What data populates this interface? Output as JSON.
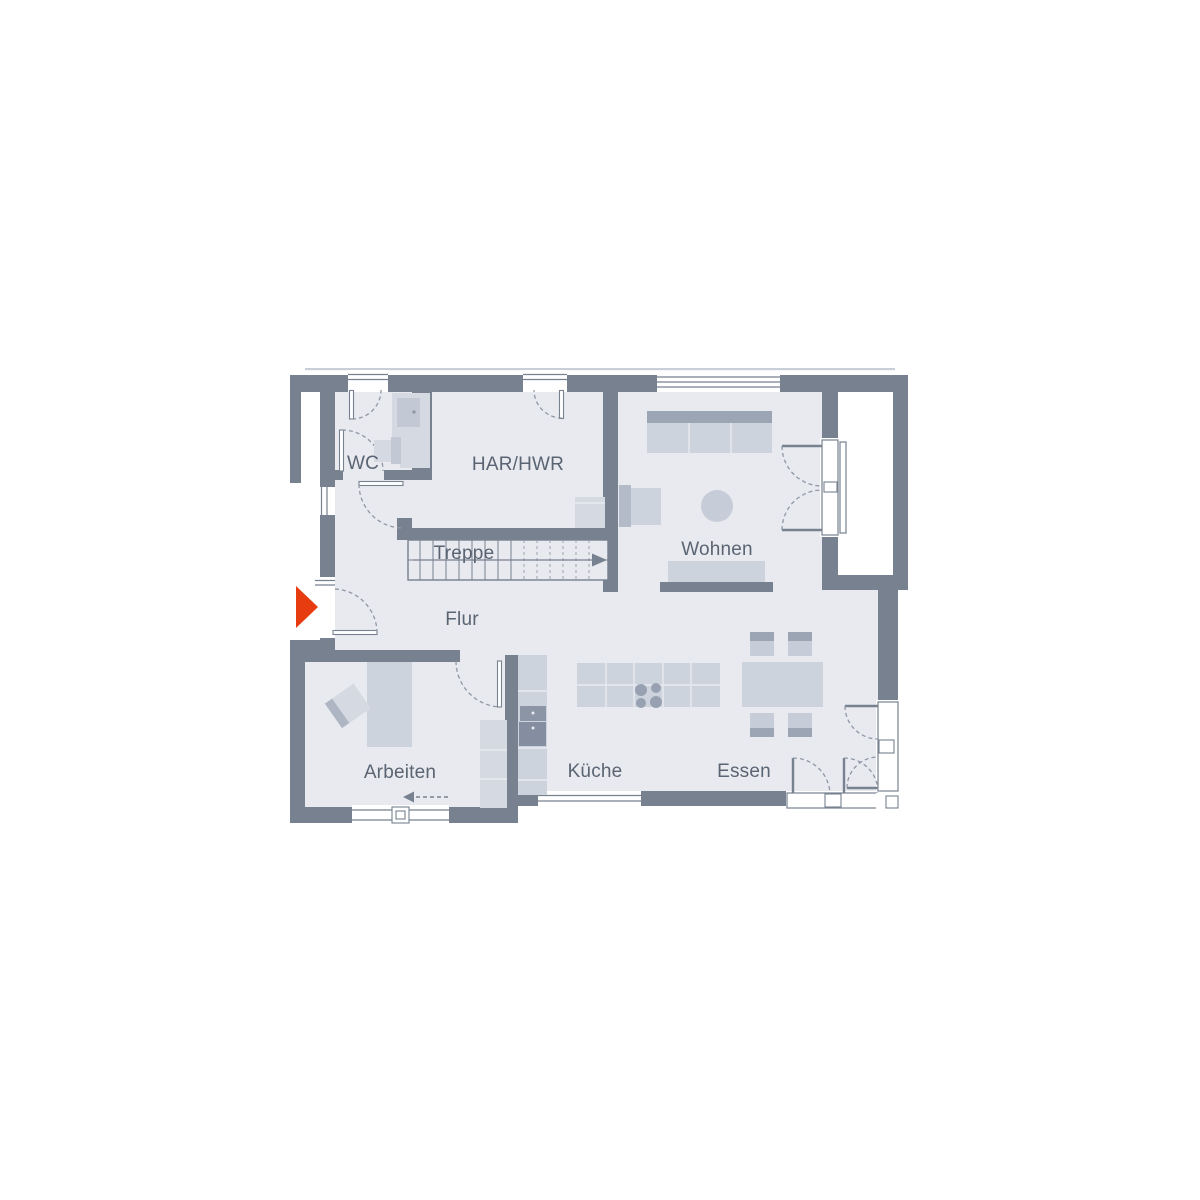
{
  "plan": {
    "kind": "residential floor plan (Grundriss)",
    "rooms": [
      {
        "key": "wc",
        "label": "WC"
      },
      {
        "key": "har_hwr",
        "label": "HAR/HWR"
      },
      {
        "key": "treppe",
        "label": "Treppe"
      },
      {
        "key": "wohnen",
        "label": "Wohnen"
      },
      {
        "key": "flur",
        "label": "Flur"
      },
      {
        "key": "arbeiten",
        "label": "Arbeiten"
      },
      {
        "key": "kueche",
        "label": "Küche"
      },
      {
        "key": "essen",
        "label": "Essen"
      }
    ],
    "icons": [
      {
        "name": "entrance-arrow-icon",
        "shape": "solid right-pointing triangle"
      },
      {
        "name": "stairs-direction-arrow-icon",
        "shape": "thin right arrow"
      },
      {
        "name": "arbeiten-direction-arrow-icon",
        "shape": "dashed left arrow"
      }
    ],
    "colors": {
      "wall": "#77818F",
      "floor": "#E8EAEF",
      "furniture_light": "#D5DAE2",
      "furniture_mid": "#CDD3DD",
      "furniture_dark": "#9CA5B4",
      "appliance": "#8C95A5",
      "label_text": "#5A6472",
      "entrance_arrow": "#E63C0F",
      "door_arc": "#8F97A6"
    }
  }
}
